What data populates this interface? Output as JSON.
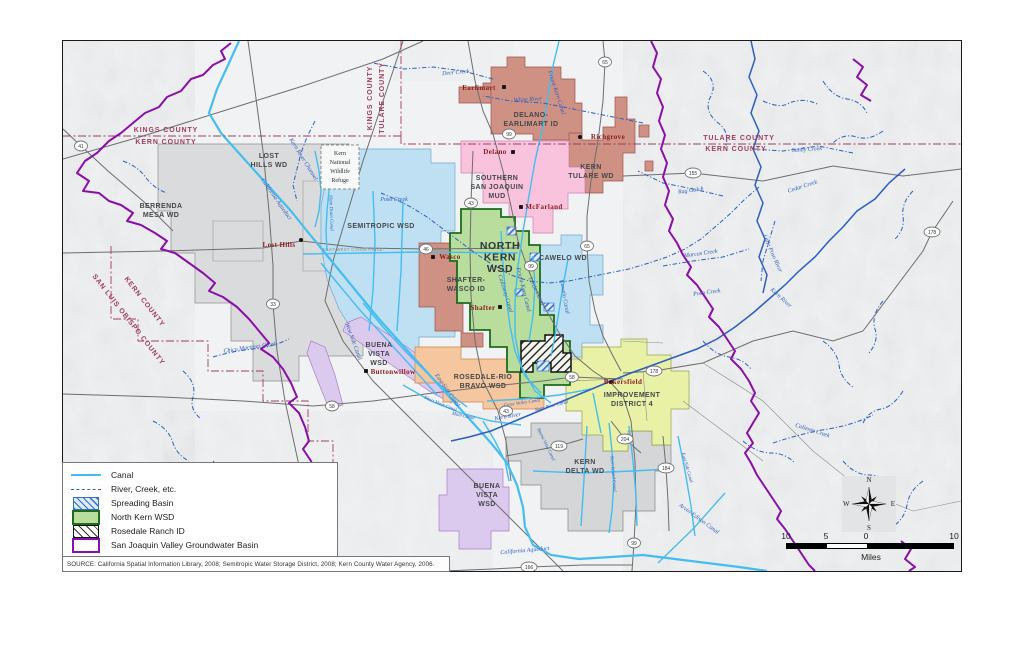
{
  "source": "SOURCE: California Spatial Information Library, 2008; Semitropic Water Storage District, 2008; Kern County Water Agency, 2006.",
  "legend": {
    "items": [
      {
        "label": "Canal",
        "swatch": "canal"
      },
      {
        "label": "River, Creek, etc.",
        "swatch": "river"
      },
      {
        "label": "Spreading Basin",
        "swatch": "spread"
      },
      {
        "label": "North Kern WSD",
        "swatch": "nk"
      },
      {
        "label": "Rosedale Ranch ID",
        "swatch": "ranch"
      },
      {
        "label": "San Joaquin Valley Groundwater Basin",
        "swatch": "gwb"
      }
    ]
  },
  "scalebar": {
    "ticks": [
      "10",
      "5",
      "0",
      "10"
    ],
    "unit": "Miles"
  },
  "compass": {
    "n": "N",
    "e": "E",
    "s": "S",
    "w": "W"
  },
  "colors": {
    "groundwater_basin": "#8a0fa8",
    "canal": "#45bdf0",
    "river": "#2c5fc0",
    "county_line": "#a03d5f",
    "north_kern_fill": "#b9dd9d",
    "north_kern_border": "#1d6b1d",
    "semitropic_fill": "#bfe0f2",
    "delano_fill": "#cf9184",
    "ssj_mud_fill": "#f9c3dd",
    "rosedale_rio_fill": "#f6c79f",
    "id4_fill": "#e8f1a6",
    "kern_delta_fill": "#d5d6d7",
    "buena_vista_fill": "#dccaee"
  },
  "map": {
    "county_labels": [
      {
        "text": "KINGS COUNTY",
        "x": 103,
        "y": 91,
        "rot": 0
      },
      {
        "text": "KERN COUNTY",
        "x": 103,
        "y": 103,
        "rot": 0
      },
      {
        "text": "KINGS COUNTY",
        "x": 309,
        "y": 57,
        "rot": -90
      },
      {
        "text": "TULARE COUNTY",
        "x": 321,
        "y": 57,
        "rot": -90
      },
      {
        "text": "TULARE COUNTY",
        "x": 676,
        "y": 99,
        "rot": 0
      },
      {
        "text": "KERN COUNTY",
        "x": 673,
        "y": 110,
        "rot": 0
      },
      {
        "text": "KERN COUNTY",
        "x": 80,
        "y": 262,
        "rot": 52
      },
      {
        "text": "SAN LUIS OBISPO COUNTY",
        "x": 64,
        "y": 280,
        "rot": 52
      }
    ],
    "district_labels": [
      {
        "lines": [
          "LOST",
          "HILLS WD"
        ],
        "x": 206,
        "y": 117
      },
      {
        "lines": [
          "BERRENDA",
          "MESA WD"
        ],
        "x": 98,
        "y": 167
      },
      {
        "lines": [
          "SEMITROPIC WSD"
        ],
        "x": 318,
        "y": 187
      },
      {
        "lines": [
          "DELANO-",
          "EARLIMART ID"
        ],
        "x": 468,
        "y": 76
      },
      {
        "lines": [
          "SOUTHERN",
          "SAN JOAQUIN",
          "MUD"
        ],
        "x": 434,
        "y": 139
      },
      {
        "lines": [
          "KERN",
          "TULARE WD"
        ],
        "x": 528,
        "y": 128
      },
      {
        "lines": [
          "NORTH",
          "KERN",
          "WSD"
        ],
        "x": 437,
        "y": 208,
        "big": true
      },
      {
        "lines": [
          "CAWELO WD"
        ],
        "x": 500,
        "y": 219
      },
      {
        "lines": [
          "SHAFTER-",
          "WASCO ID"
        ],
        "x": 403,
        "y": 241
      },
      {
        "lines": [
          "BUENA",
          "VISTA",
          "WSD"
        ],
        "x": 316,
        "y": 306
      },
      {
        "lines": [
          "ROSEDALE-RIO",
          "BRAVO WSD"
        ],
        "x": 420,
        "y": 338
      },
      {
        "lines": [
          "IMPROVEMENT",
          "DISTRICT 4"
        ],
        "x": 569,
        "y": 356
      },
      {
        "lines": [
          "KERN",
          "DELTA WD"
        ],
        "x": 522,
        "y": 423
      },
      {
        "lines": [
          "BUENA",
          "VISTA",
          "WSD"
        ],
        "x": 424,
        "y": 447
      }
    ],
    "refuge": {
      "lines": [
        "Kern",
        "National",
        "Wildlife",
        "Refuge"
      ],
      "x": 277,
      "y": 114
    },
    "conveyance_label": {
      "text": "EAST-WEST CONVEYANCE",
      "x": 290,
      "y": 210
    },
    "towns": [
      {
        "name": "Earlimart",
        "x": 416,
        "y": 49,
        "marker": "sq",
        "mx": 441,
        "my": 46
      },
      {
        "name": "Richgrove",
        "x": 545,
        "y": 98,
        "marker": "dot",
        "mx": 517,
        "my": 96
      },
      {
        "name": "Delano",
        "x": 432,
        "y": 113,
        "marker": "sq",
        "mx": 450,
        "my": 111
      },
      {
        "name": "McFarland",
        "x": 481,
        "y": 168,
        "marker": "sq",
        "mx": 458,
        "my": 166
      },
      {
        "name": "Wasco",
        "x": 387,
        "y": 218,
        "marker": "sq",
        "mx": 370,
        "my": 216
      },
      {
        "name": "Shafter",
        "x": 420,
        "y": 269,
        "marker": "sq",
        "mx": 437,
        "my": 266
      },
      {
        "name": "Lost Hills",
        "x": 216,
        "y": 206,
        "marker": "dot",
        "mx": 238,
        "my": 199
      },
      {
        "name": "Buttonwillow",
        "x": 330,
        "y": 333,
        "marker": "sq",
        "mx": 303,
        "my": 330
      },
      {
        "name": "Bakersfield",
        "x": 560,
        "y": 343,
        "marker": "dot",
        "mx": 548,
        "my": 341
      }
    ],
    "water_labels": [
      {
        "text": "Deer Creek",
        "x": 393,
        "y": 33,
        "rot": -5
      },
      {
        "text": "White River",
        "x": 465,
        "y": 60,
        "rot": -3
      },
      {
        "text": "Friant-Kern Canal",
        "x": 492,
        "y": 52,
        "rot": 72
      },
      {
        "text": "Rag Gulch",
        "x": 628,
        "y": 151,
        "rot": -8
      },
      {
        "text": "Sandy Creek",
        "x": 744,
        "y": 110,
        "rot": -4
      },
      {
        "text": "Cedar Creek",
        "x": 740,
        "y": 147,
        "rot": -18
      },
      {
        "text": "Poso Creek",
        "x": 331,
        "y": 160,
        "rot": 0
      },
      {
        "text": "Poso Creek",
        "x": 644,
        "y": 253,
        "rot": -8
      },
      {
        "text": "Marcus Creek",
        "x": 638,
        "y": 214,
        "rot": -8
      },
      {
        "text": "Little Poso River",
        "x": 708,
        "y": 213,
        "rot": 66
      },
      {
        "text": "Kern River",
        "x": 717,
        "y": 258,
        "rot": 42
      },
      {
        "text": "Kern River",
        "x": 445,
        "y": 377,
        "rot": -10
      },
      {
        "text": "California Aqueduct",
        "x": 212,
        "y": 159,
        "rot": 55
      },
      {
        "text": "California Aqueduct",
        "x": 462,
        "y": 511,
        "rot": -5
      },
      {
        "text": "Kern River Channel",
        "x": 239,
        "y": 119,
        "rot": 58
      },
      {
        "text": "Main Drain Canal",
        "x": 267,
        "y": 172,
        "rot": 88,
        "sm": true
      },
      {
        "text": "Calloway Canal",
        "x": 441,
        "y": 253,
        "rot": 73
      },
      {
        "text": "Friant-Kern Canal",
        "x": 459,
        "y": 249,
        "rot": 76
      },
      {
        "text": "Lerdo Canal",
        "x": 472,
        "y": 251,
        "rot": 64
      },
      {
        "text": "Cawelo Canal",
        "x": 500,
        "y": 256,
        "rot": 80
      },
      {
        "text": "West Side Canal",
        "x": 289,
        "y": 301,
        "rot": 70
      },
      {
        "text": "East Side Canal",
        "x": 383,
        "y": 350,
        "rot": 55
      },
      {
        "text": "Short Main Canal",
        "x": 377,
        "y": 364,
        "rot": 22,
        "sm": true
      },
      {
        "text": "Main Canal",
        "x": 400,
        "y": 376,
        "rot": 12,
        "sm": true
      },
      {
        "text": "Cross Valley Canal",
        "x": 459,
        "y": 363,
        "rot": -8,
        "sm": true
      },
      {
        "text": "Kern River Canal",
        "x": 489,
        "y": 366,
        "rot": -14,
        "sm": true
      },
      {
        "text": "Buena Vista Canal",
        "x": 482,
        "y": 404,
        "rot": 64,
        "sm": true
      },
      {
        "text": "Kern Island Canal",
        "x": 549,
        "y": 433,
        "rot": 85,
        "sm": true
      },
      {
        "text": "East Side Canal",
        "x": 623,
        "y": 427,
        "rot": 74,
        "sm": true
      },
      {
        "text": "Arvin-Edison Canal",
        "x": 635,
        "y": 479,
        "rot": 36
      },
      {
        "text": "Caliente Creek",
        "x": 749,
        "y": 391,
        "rot": 18
      },
      {
        "text": "Chico Martinez Creek",
        "x": 187,
        "y": 308,
        "rot": -8
      }
    ],
    "highway_shields": [
      {
        "n": "41",
        "x": 18,
        "y": 105
      },
      {
        "n": "65",
        "x": 542,
        "y": 21
      },
      {
        "n": "99",
        "x": 446,
        "y": 93
      },
      {
        "n": "43",
        "x": 408,
        "y": 162
      },
      {
        "n": "155",
        "x": 630,
        "y": 132
      },
      {
        "n": "46",
        "x": 363,
        "y": 208
      },
      {
        "n": "65",
        "x": 524,
        "y": 205
      },
      {
        "n": "99",
        "x": 468,
        "y": 225
      },
      {
        "n": "33",
        "x": 210,
        "y": 263
      },
      {
        "n": "178",
        "x": 869,
        "y": 191
      },
      {
        "n": "58",
        "x": 269,
        "y": 365
      },
      {
        "n": "58",
        "x": 509,
        "y": 336
      },
      {
        "n": "178",
        "x": 591,
        "y": 330
      },
      {
        "n": "43",
        "x": 443,
        "y": 370
      },
      {
        "n": "119",
        "x": 496,
        "y": 405
      },
      {
        "n": "204",
        "x": 562,
        "y": 398
      },
      {
        "n": "184",
        "x": 603,
        "y": 427
      },
      {
        "n": "99",
        "x": 571,
        "y": 502
      },
      {
        "n": "166",
        "x": 466,
        "y": 526
      }
    ]
  }
}
